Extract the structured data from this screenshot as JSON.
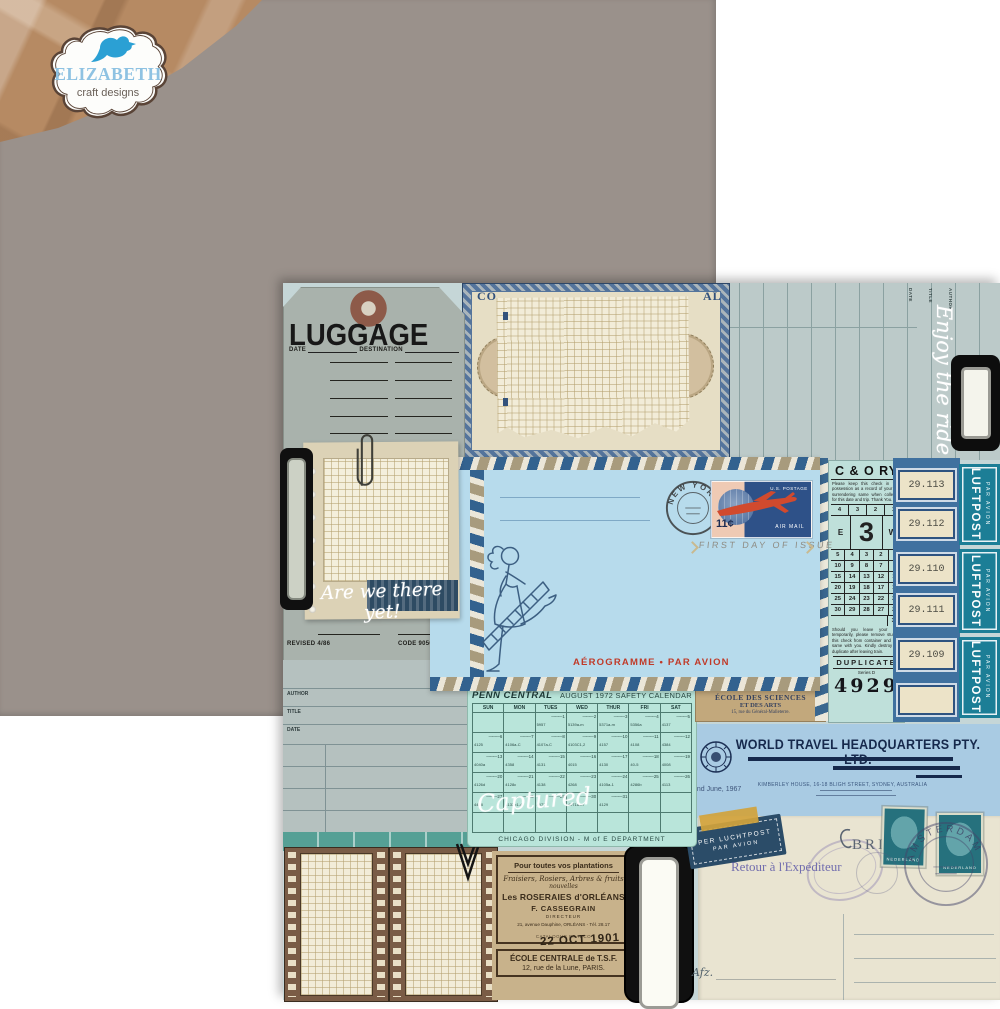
{
  "logo": {
    "name": "ELIZABETH",
    "subtitle": "craft designs"
  },
  "tag": {
    "title": "LUGGAGE",
    "date_label": "DATE",
    "dest_label": "DESTINATION",
    "revised": "REVISED 4/86",
    "code": "CODE 90506550"
  },
  "note": {
    "script": "Are we there yet!"
  },
  "cert": {
    "left": "CO",
    "right": "AL"
  },
  "ledger": {
    "script": "Enjoy the ride",
    "labels": [
      "DATE",
      "TITLE",
      "AUTHOR"
    ]
  },
  "library_card": {
    "labels": [
      "AUTHOR",
      "TITLE",
      "DATE"
    ]
  },
  "envelope": {
    "postmark_city": "NEW YORK",
    "stamp_postage": "U.S. POSTAGE",
    "stamp_value": "11¢",
    "stamp_airmail": "AIR MAIL",
    "first_day": "FIRST DAY OF ISSUE",
    "aerogramme": "AÉROGRAMME • PAR AVION"
  },
  "ticket": {
    "title": "C & O RY",
    "notice_top": "Please keep this check in your possession as a record of your trip, surrendering same when collected for this date and trip. Thank You.",
    "row_top": [
      "4",
      "3",
      "2",
      "1"
    ],
    "east": "E",
    "car_number": "3",
    "west": "W",
    "rows": [
      [
        "5",
        "4",
        "3",
        "2",
        "1"
      ],
      [
        "10",
        "9",
        "8",
        "7",
        "6"
      ],
      [
        "15",
        "14",
        "13",
        "12",
        "11"
      ],
      [
        "20",
        "19",
        "18",
        "17",
        "16"
      ],
      [
        "25",
        "24",
        "23",
        "22",
        "21"
      ],
      [
        "30",
        "29",
        "28",
        "27",
        "26"
      ],
      [
        "31"
      ]
    ],
    "notice_bottom": "Should you leave your seat temporarily, please remove stub of this check from container and take same with you. Kindly destroy this duplicate after leaving train.",
    "duplicate": "DUPLICATE",
    "series": "Series D",
    "number": "4929"
  },
  "baggage_labels": {
    "values": [
      "29.113",
      "29.112",
      "29.110",
      "29.111",
      "29.109",
      ""
    ]
  },
  "luftpost": {
    "title": "LUFTPOST",
    "subtitle": "PAR AVION"
  },
  "ecole": {
    "line1": "ÉCOLE DES SCIENCES",
    "line2": "ET DES ARTS",
    "line3": "15, rue du Général-Malleterre."
  },
  "calendar": {
    "brand": "PENN CENTRAL",
    "title": "AUGUST 1972 SAFETY CALENDAR",
    "days": [
      "SUN",
      "MON",
      "TUES",
      "WED",
      "THUR",
      "FRI",
      "SAT"
    ],
    "weeks": [
      [
        {
          "d": "",
          "c": ""
        },
        {
          "d": "",
          "c": ""
        },
        {
          "d": "1",
          "c": "5957"
        },
        {
          "d": "2",
          "c": "5139a-m"
        },
        {
          "d": "3",
          "c": "5371a-m"
        },
        {
          "d": "4",
          "c": "5356a"
        },
        {
          "d": "5",
          "c": "4137"
        }
      ],
      [
        {
          "d": "6",
          "c": "4125"
        },
        {
          "d": "7",
          "c": "4106a-C"
        },
        {
          "d": "8",
          "c": "4107a-C"
        },
        {
          "d": "9",
          "c": "4103C1,2"
        },
        {
          "d": "10",
          "c": "4157"
        },
        {
          "d": "11",
          "c": "4108"
        },
        {
          "d": "12",
          "c": "4384"
        }
      ],
      [
        {
          "d": "13",
          "c": "4040a"
        },
        {
          "d": "14",
          "c": "4358"
        },
        {
          "d": "15",
          "c": "4131"
        },
        {
          "d": "16",
          "c": "4015"
        },
        {
          "d": "17",
          "c": "4130"
        },
        {
          "d": "18",
          "c": "40-5"
        },
        {
          "d": "19",
          "c": "4008"
        }
      ],
      [
        {
          "d": "20",
          "c": "4126d"
        },
        {
          "d": "21",
          "c": "4128c"
        },
        {
          "d": "22",
          "c": "4138"
        },
        {
          "d": "23",
          "c": "4268"
        },
        {
          "d": "24",
          "c": "4105a-1"
        },
        {
          "d": "25",
          "c": "4286b"
        },
        {
          "d": "26",
          "c": "4113"
        }
      ],
      [
        {
          "d": "27",
          "c": "4468"
        },
        {
          "d": "28",
          "c": "4132b1-4"
        },
        {
          "d": "29",
          "c": "4972"
        },
        {
          "d": "30",
          "c": "4071a-m"
        },
        {
          "d": "31",
          "c": "4129"
        },
        {
          "d": "",
          "c": ""
        },
        {
          "d": "",
          "c": ""
        }
      ],
      [
        {
          "d": "",
          "c": ""
        },
        {
          "d": "",
          "c": ""
        },
        {
          "d": "",
          "c": ""
        },
        {
          "d": "",
          "c": ""
        },
        {
          "d": "",
          "c": ""
        },
        {
          "d": "",
          "c": ""
        },
        {
          "d": "",
          "c": ""
        }
      ]
    ],
    "footer": "CHICAGO DIVISION  -  M of E DEPARTMENT",
    "script": "Captured"
  },
  "letterhead": {
    "company": "WORLD TRAVEL HEADQUARTERS PTY. LTD.",
    "address": "KIMBERLEY HOUSE, 16-18 BLIGH STREET, SYDNEY, AUSTRALIA",
    "date": "2nd June, 1967"
  },
  "french_ad": {
    "header": "Pour toutes vos plantations",
    "line2": "Fraisiers, Rosiers, Arbres & fruits",
    "line3": "nouvelles",
    "name": "Les ROSERAIES d'ORLÉANS",
    "owner": "F. CASSEGRAIN",
    "role": "DIRECTEUR",
    "address": "21, avenue Dauphine, ORLÉANS - Tél. 28.17",
    "datestamp": "22 OCT 1901",
    "catalog": "CATALOGUE FRANCO",
    "school_name": "ÉCOLE CENTRALE de T.S.F.",
    "school_address": "12, rue de la Lune, PARIS."
  },
  "postcard": {
    "label_line1": "PER LUCHTPOST",
    "label_line2": "PAR AVION",
    "retour": "Retour à l'Expéditeur",
    "brief": "BRIEF",
    "stamp_country": "NEDERLAND",
    "postmark_city": "AMSTERDAM",
    "afz": "Afz."
  }
}
